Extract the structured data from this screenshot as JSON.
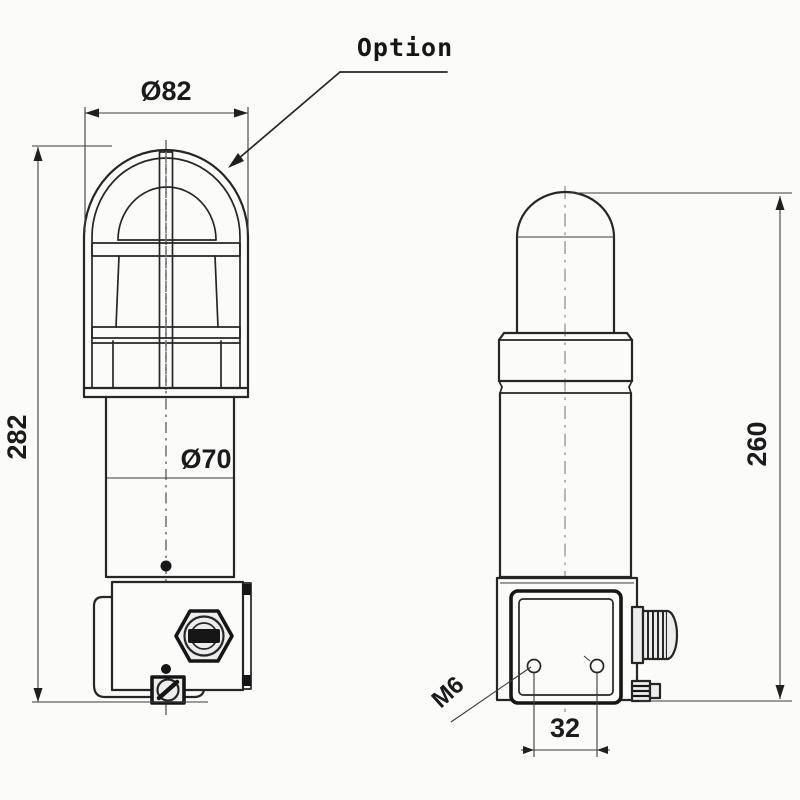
{
  "drawing": {
    "kind": "beacon-technical-drawing",
    "views": [
      "front view with optional guard cage",
      "side view"
    ],
    "labels": {
      "option": "Option",
      "cage_diameter": "Ø82",
      "overall_height": "282",
      "body_diameter": "Ø70",
      "beacon_height": "260",
      "mounting_thread": "M6",
      "hole_spacing": "32"
    },
    "colors": {
      "line": "#262626",
      "background": "#fbfbfa",
      "text": "#1b1b1b"
    }
  }
}
